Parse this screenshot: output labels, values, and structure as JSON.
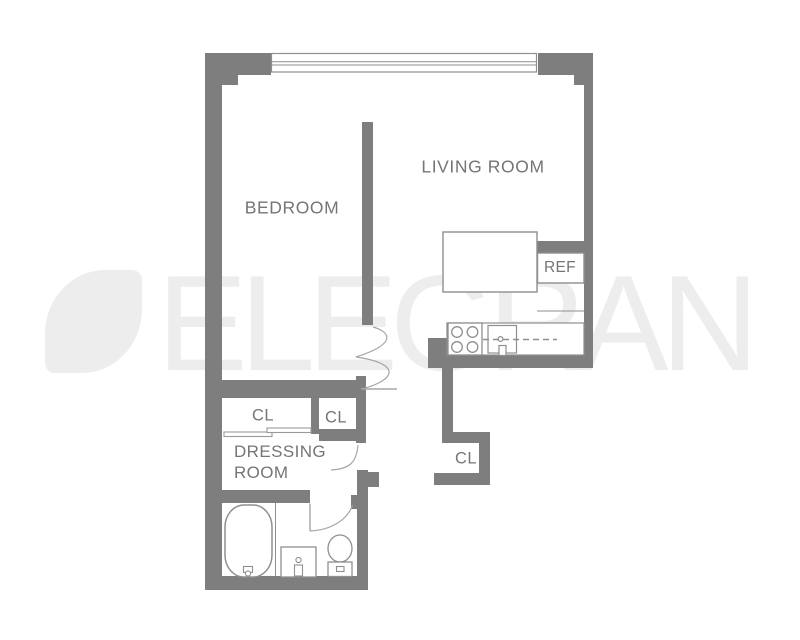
{
  "plan": {
    "labels": {
      "bedroom": "BEDROOM",
      "living_room": "LIVING ROOM",
      "dressing_room": "DRESSING\nROOM",
      "closet_left": "CL",
      "closet_right": "CL",
      "closet_hall": "CL",
      "refrigerator": "REF"
    }
  },
  "watermark": {
    "brand": "ELEGRAN"
  },
  "colors": {
    "wall": "#7e7e7e",
    "fixture_outline": "#8f8f8f",
    "door_arc": "#a6a6a6",
    "label_text": "#757575",
    "watermark": "#ededed",
    "background": "#ffffff"
  }
}
